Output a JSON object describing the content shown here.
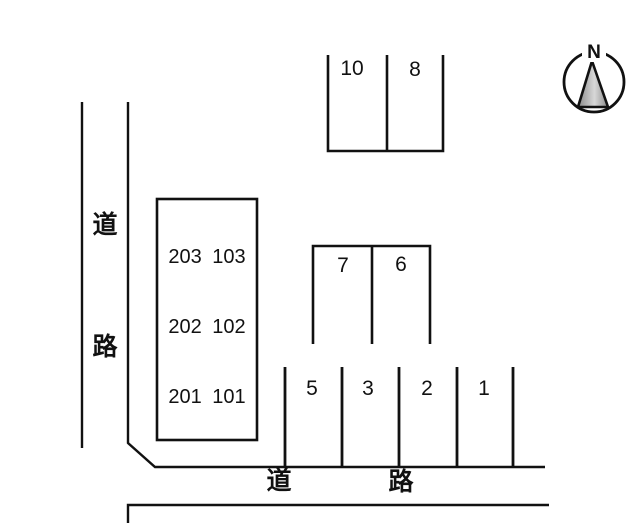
{
  "compass": {
    "north_label": "N"
  },
  "roads": {
    "left": {
      "chars": [
        "道",
        "路"
      ]
    },
    "bottom": {
      "chars": [
        "道",
        "路"
      ]
    }
  },
  "building": {
    "room_rows": [
      "203 103",
      "202 102",
      "201 101"
    ]
  },
  "parking": {
    "top_row": [
      "10",
      "8"
    ],
    "middle_row": [
      "7",
      "6"
    ],
    "bottom_row": [
      "5",
      "3",
      "2",
      "1"
    ]
  },
  "colors": {
    "line": "#111111",
    "background": "#ffffff",
    "compass_fill_dark": "#8a8a8a",
    "compass_fill_light": "#d8d8d8"
  }
}
